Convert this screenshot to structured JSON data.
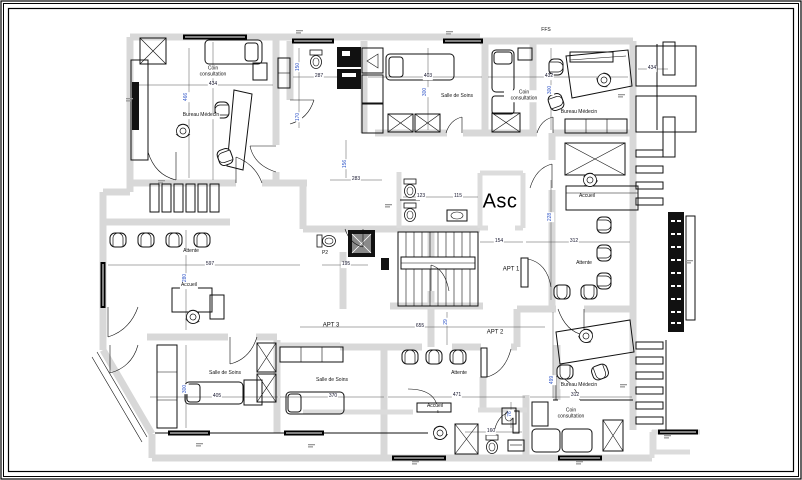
{
  "drawing": {
    "type": "architectural-floor-plan-medical-offices",
    "colors": {
      "paper": "#ffffff",
      "wall_fill": "#d8d8d8",
      "line": "#111111",
      "dim_horizontal": "#15152e",
      "dim_vertical": "#2f55c8"
    },
    "room_labels": [
      {
        "text": "Coin consultation"
      },
      {
        "text": "Bureau Médecin"
      },
      {
        "text": "Salle de Soins"
      },
      {
        "text": "Coin consultation"
      },
      {
        "text": "Bureau Médecin"
      },
      {
        "text": "Accueil"
      },
      {
        "text": "Attente"
      },
      {
        "text": "Attente"
      },
      {
        "text": "Accueil"
      },
      {
        "text": "Salle de Soins"
      },
      {
        "text": "Salle de Soins"
      },
      {
        "text": "Attente"
      },
      {
        "text": "Accueil"
      },
      {
        "text": "Bureau Médecin"
      },
      {
        "text": "Coin consultation"
      },
      {
        "text": "Asc"
      },
      {
        "text": "FFS"
      },
      {
        "text": "APT 1"
      },
      {
        "text": "APT 2"
      },
      {
        "text": "APT 3"
      },
      {
        "text": "P2"
      }
    ],
    "dimensions": [
      {
        "text": "434"
      },
      {
        "text": "466"
      },
      {
        "text": "287"
      },
      {
        "text": "150"
      },
      {
        "text": "170"
      },
      {
        "text": "403"
      },
      {
        "text": "300"
      },
      {
        "text": "432"
      },
      {
        "text": "300"
      },
      {
        "text": "283"
      },
      {
        "text": "156"
      },
      {
        "text": "123"
      },
      {
        "text": "115"
      },
      {
        "text": "154"
      },
      {
        "text": "312"
      },
      {
        "text": "228"
      },
      {
        "text": "597"
      },
      {
        "text": "280"
      },
      {
        "text": "195"
      },
      {
        "text": "655"
      },
      {
        "text": "29"
      },
      {
        "text": "405"
      },
      {
        "text": "300"
      },
      {
        "text": "370"
      },
      {
        "text": "471"
      },
      {
        "text": "160"
      },
      {
        "text": "76"
      },
      {
        "text": "312"
      },
      {
        "text": "499"
      },
      {
        "text": "434"
      }
    ]
  }
}
